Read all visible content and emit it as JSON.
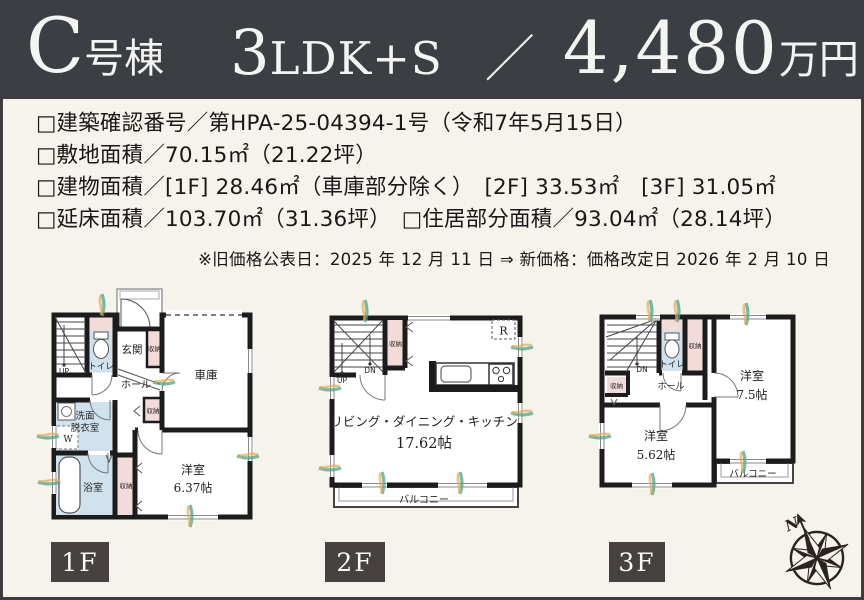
{
  "header": {
    "building_letter": "C",
    "building_suffix": "号棟",
    "plan_number": "3",
    "plan_suffix": "LDK+S",
    "slash": "／",
    "price": "4,480",
    "price_unit": "万円"
  },
  "details": {
    "lines": [
      "□建築確認番号／第HPA-25-04394-1号（令和7年5月15日）",
      "□敷地面積／70.15㎡（21.22坪）",
      "□建物面積／[1F] 28.46㎡（車庫部分除く）　[2F] 33.53㎡　[3F] 31.05㎡",
      "□延床面積／103.70㎡（31.36坪）　□住居部分面積／93.04㎡（28.14坪）"
    ],
    "note": "※旧価格公表日：2025 年 12 月 11 日 ⇒ 新価格：価格改定日 2026 年 2 月 10 日"
  },
  "plans": {
    "f1": {
      "entrance": "玄関",
      "toilet": "トイレ",
      "hall": "ホール",
      "garage": "車庫",
      "storage": "収納",
      "washroom_l1": "洗面",
      "washroom_l2": "脱衣室",
      "washer": "W",
      "bath": "浴室",
      "room": "洋室",
      "room_size": "6.37帖",
      "up": "UP"
    },
    "f2": {
      "up": "UP",
      "down": "DN",
      "storage": "収納",
      "fridge": "R",
      "ldk": "リビング・ダイニング・キッチン",
      "ldk_size": "17.62帖",
      "balcony": "バルコニー"
    },
    "f3": {
      "down": "DN",
      "toilet": "トイレ",
      "storage": "収納",
      "hall": "ホール",
      "room1": "洋室",
      "room1_size": "7.5帖",
      "room2": "洋室",
      "room2_size": "5.62帖",
      "balcony": "バルコニー"
    }
  },
  "floor_tabs": [
    {
      "label": "1F"
    },
    {
      "label": "2F"
    },
    {
      "label": "3F"
    }
  ],
  "compass": {
    "north": "N"
  },
  "colors": {
    "header_bg": "#3b3e43",
    "background": "#f6f3ec",
    "wall": "#1c1c1c",
    "wet_area_fill": "#cfe2ed",
    "storage_fill": "#f2dbd8",
    "tab_bg": "#474240",
    "accent_teal": "#49a58b",
    "accent_orange": "#e9a94f"
  }
}
